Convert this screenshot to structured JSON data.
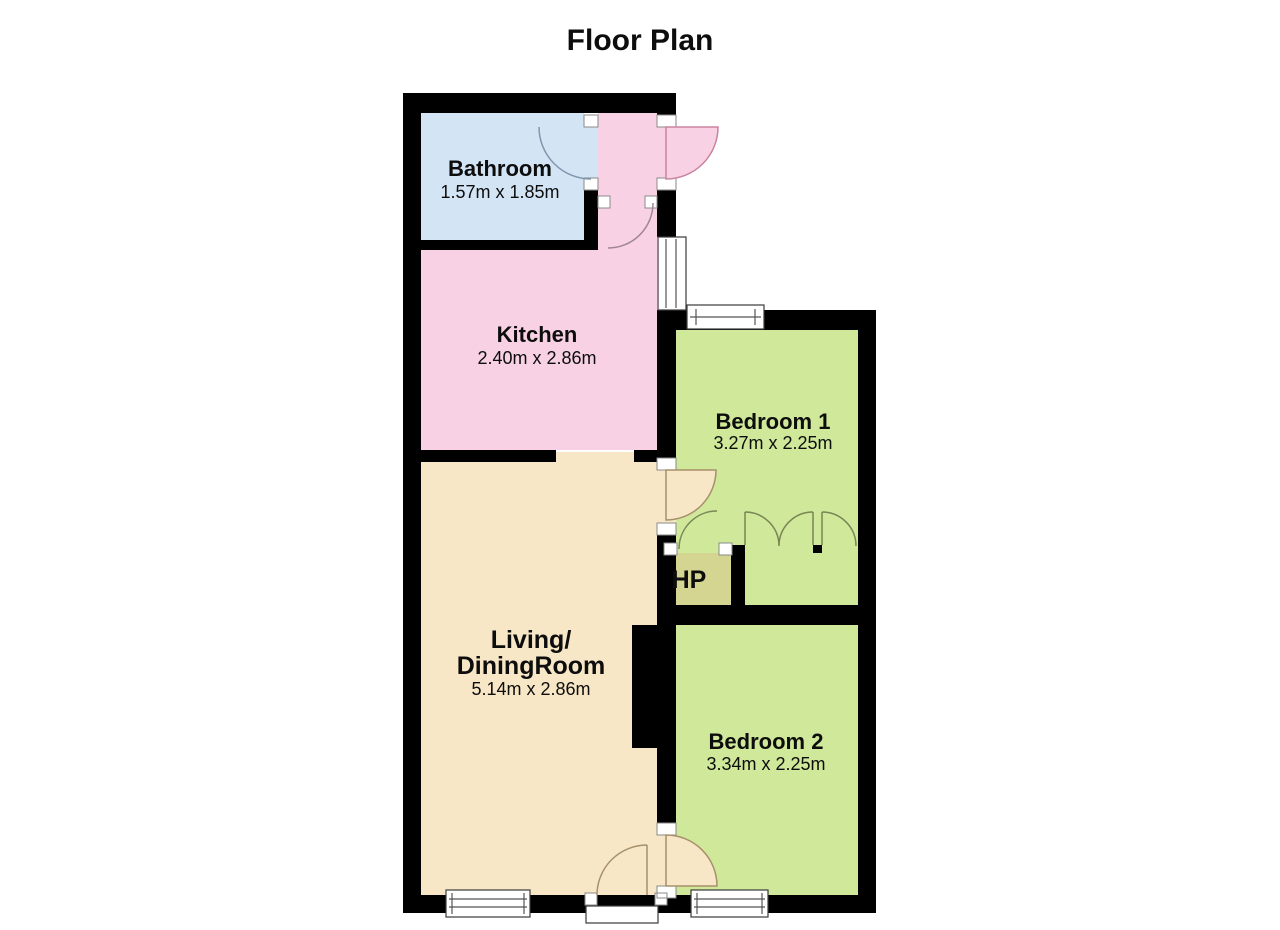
{
  "title": "Floor Plan",
  "rooms": {
    "bathroom": {
      "name": "Bathroom",
      "dims": "1.57m x 1.85m"
    },
    "kitchen": {
      "name": "Kitchen",
      "dims": "2.40m x 2.86m"
    },
    "bedroom1": {
      "name": "Bedroom 1",
      "dims": "3.27m x 2.25m"
    },
    "hp": {
      "name": "HP"
    },
    "living": {
      "name_line1": "Living/",
      "name_line2": "DiningRoom",
      "dims": "5.14m x 2.86m"
    },
    "bedroom2": {
      "name": "Bedroom 2",
      "dims": "3.34m x 2.25m"
    }
  },
  "colors": {
    "wall": "#000000",
    "bathroom": "#d3e4f5",
    "kitchen": "#f8d2e4",
    "living": "#f7e7c6",
    "bedroom": "#cfe899",
    "hp": "#d5d592",
    "door_arc_tan": "#a8906c",
    "door_arc_pink": "#c9849e",
    "door_arc_blue": "#8096ad",
    "door_arc_green": "#7a8656",
    "door_arc_mauve": "#a18599",
    "window_border": "#3a3a3a",
    "jamb_border": "#8a8a8a"
  }
}
